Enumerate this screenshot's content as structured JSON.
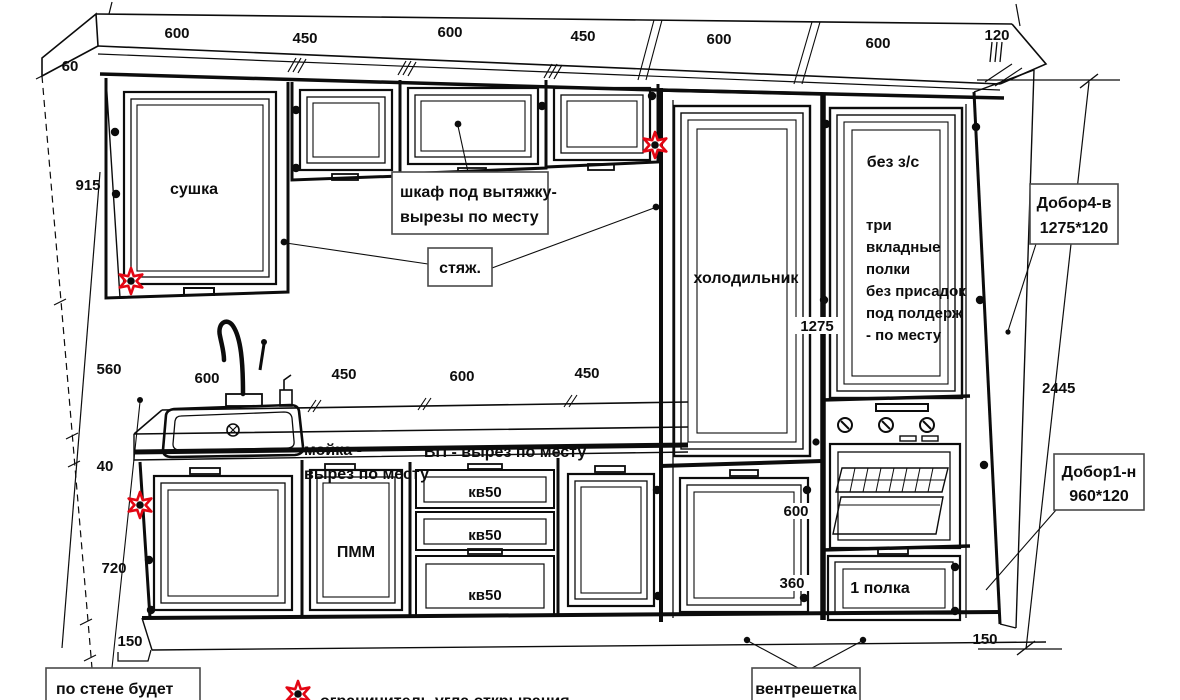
{
  "drawing": {
    "dims": {
      "top": [
        "600",
        "450",
        "600",
        "450",
        "600",
        "600",
        "120"
      ],
      "left": [
        "60",
        "915",
        "560",
        "40",
        "720",
        "150"
      ],
      "counter": [
        "600",
        "450",
        "600",
        "450"
      ],
      "total_height": "2445",
      "fridge_door_height": "1275",
      "under_fridge_height": "600",
      "drawer_height": "360",
      "plinth_right": "150"
    },
    "labels": {
      "dryer": "сушка",
      "hood_line1": "шкаф под вытяжку-",
      "hood_line2": "вырезы по месту",
      "tie": "стяж.",
      "fridge": "холодильник",
      "no_back": "без з/с",
      "shelves": [
        "три",
        "вкладные",
        "полки",
        "без присадок",
        "под полдерж",
        "- по месту"
      ],
      "sink_line1": "мойка -",
      "sink_line2": "вырез по месту",
      "worktop": "ВП - вырез по месту",
      "dishwasher": "ПММ",
      "drawer50": "кв50",
      "one_shelf": "1 полка",
      "filler_top_line1": "Добор4-в",
      "filler_top_line2": "1275*120",
      "filler_bottom_line1": "Добор1-н",
      "filler_bottom_line2": "960*120",
      "vent_grille": "вентрешетка",
      "wall_note": "по стене будет",
      "legend_limiter": "ограничитель угла открывания"
    },
    "colors": {
      "line": "#0c0c0c",
      "star": "#e30613",
      "text": "#0d0d0d"
    }
  }
}
